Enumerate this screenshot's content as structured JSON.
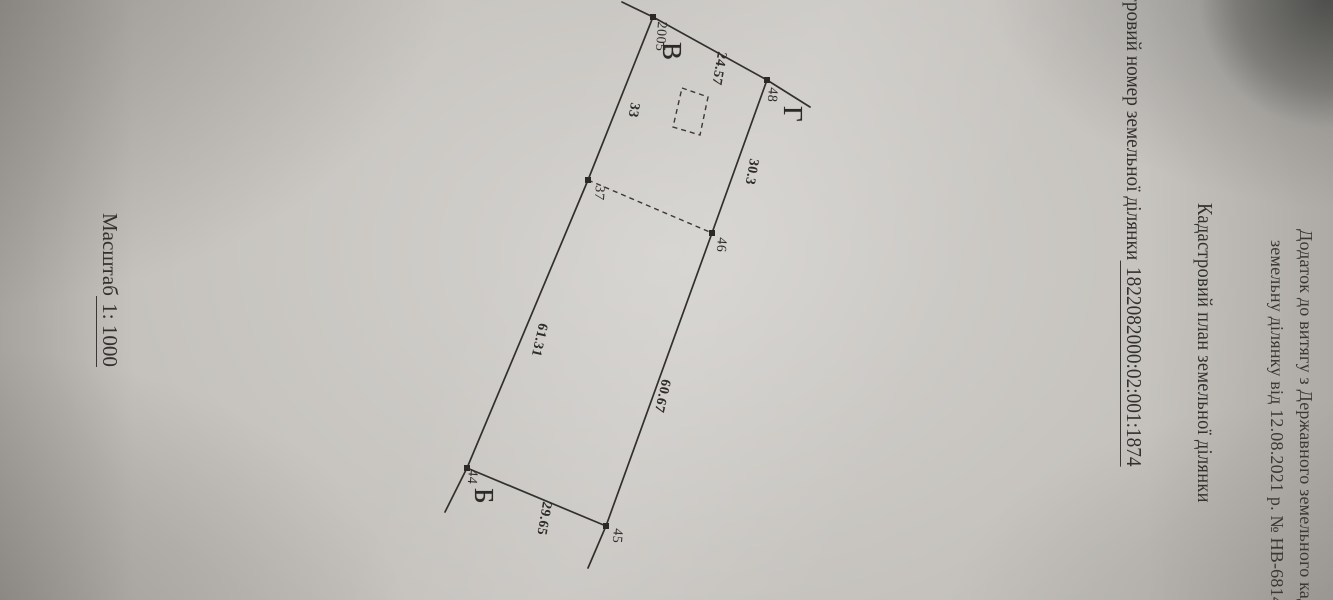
{
  "annex": {
    "line1": "Додаток до витягу з Державного земельного кад",
    "line2": "земельну ділянку від 12.08.2021 р. № НВ-681442"
  },
  "title": "Кадастровий план земельної ділянки",
  "cadastral": {
    "label": "Кадастровий номер земельної ділянки",
    "number": "1822082000:02:001:1874"
  },
  "scale": {
    "label": "Масштаб",
    "value": "1: 1000"
  },
  "parcel": {
    "corners": [
      {
        "letter": "В"
      },
      {
        "letter": "Г"
      },
      {
        "letter": "Б"
      }
    ],
    "points": [
      {
        "id": "2005"
      },
      {
        "id": "48"
      },
      {
        "id": "37"
      },
      {
        "id": "46"
      },
      {
        "id": "44"
      },
      {
        "id": "45"
      }
    ],
    "edges": [
      {
        "length": "24.57"
      },
      {
        "length": "30.3"
      },
      {
        "length": "33"
      },
      {
        "length": "61.31"
      },
      {
        "length": "60.67"
      },
      {
        "length": "29.65"
      }
    ]
  },
  "colors": {
    "paper": "#c2bfba",
    "ink": "#33312e",
    "corner_shadow": "#55534e"
  }
}
